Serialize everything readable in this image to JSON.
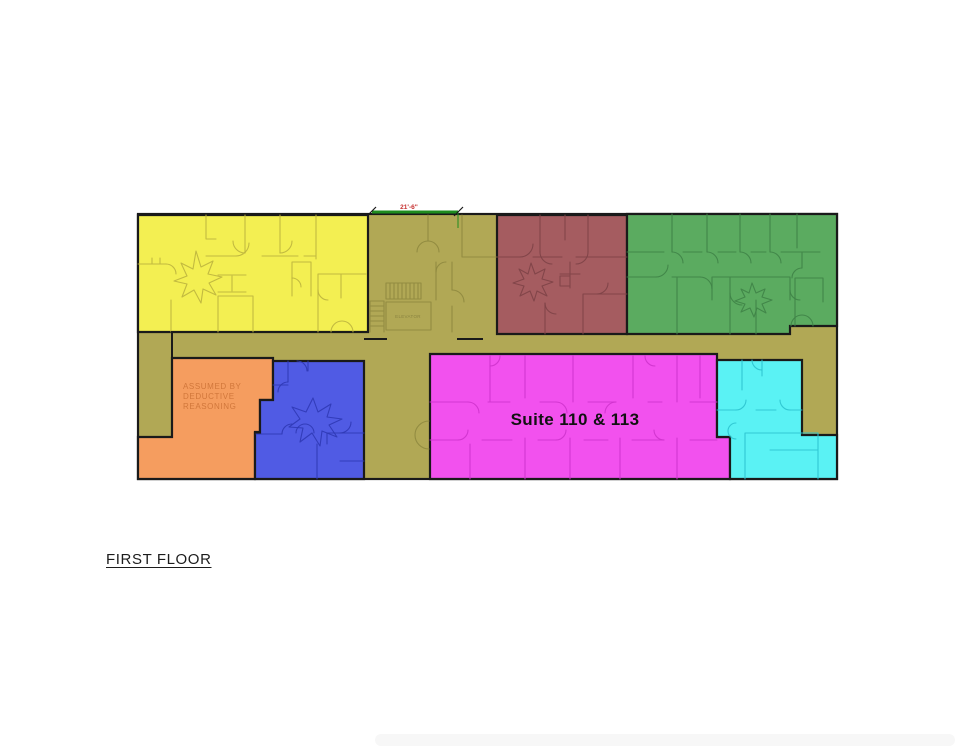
{
  "plan": {
    "title": "FIRST FLOOR",
    "labels": {
      "suite": "Suite 110 & 113",
      "elevator": "ELEVATOR",
      "assumed_lines": [
        "ASSUMED BY",
        "DEDUCTIVE",
        "REASONING"
      ],
      "dimension": "21'-6\""
    },
    "colors": {
      "outline": "#1a1a1a",
      "corridor_fill": "#b1a855",
      "corridor_line": "#8f883f",
      "yellow_fill": "#f3ef52",
      "yellow_line": "#bdb43e",
      "maroon_fill": "#a55c60",
      "maroon_line": "#7e4347",
      "green_fill": "#5bab60",
      "green_line": "#3f8347",
      "orange_fill": "#f59d5f",
      "orange_text": "#d1773b",
      "blue_fill": "#505be4",
      "blue_line": "#2f38b5",
      "magenta_fill": "#f251ee",
      "magenta_line": "#cf33cd",
      "cyan_fill": "#5af2f4",
      "cyan_line": "#2cc3cf",
      "dimension_line": "#1f8c1f",
      "dimension_text": "#c62f2f",
      "suite_text": "#111111",
      "elevator_text": "#8a8340"
    }
  }
}
